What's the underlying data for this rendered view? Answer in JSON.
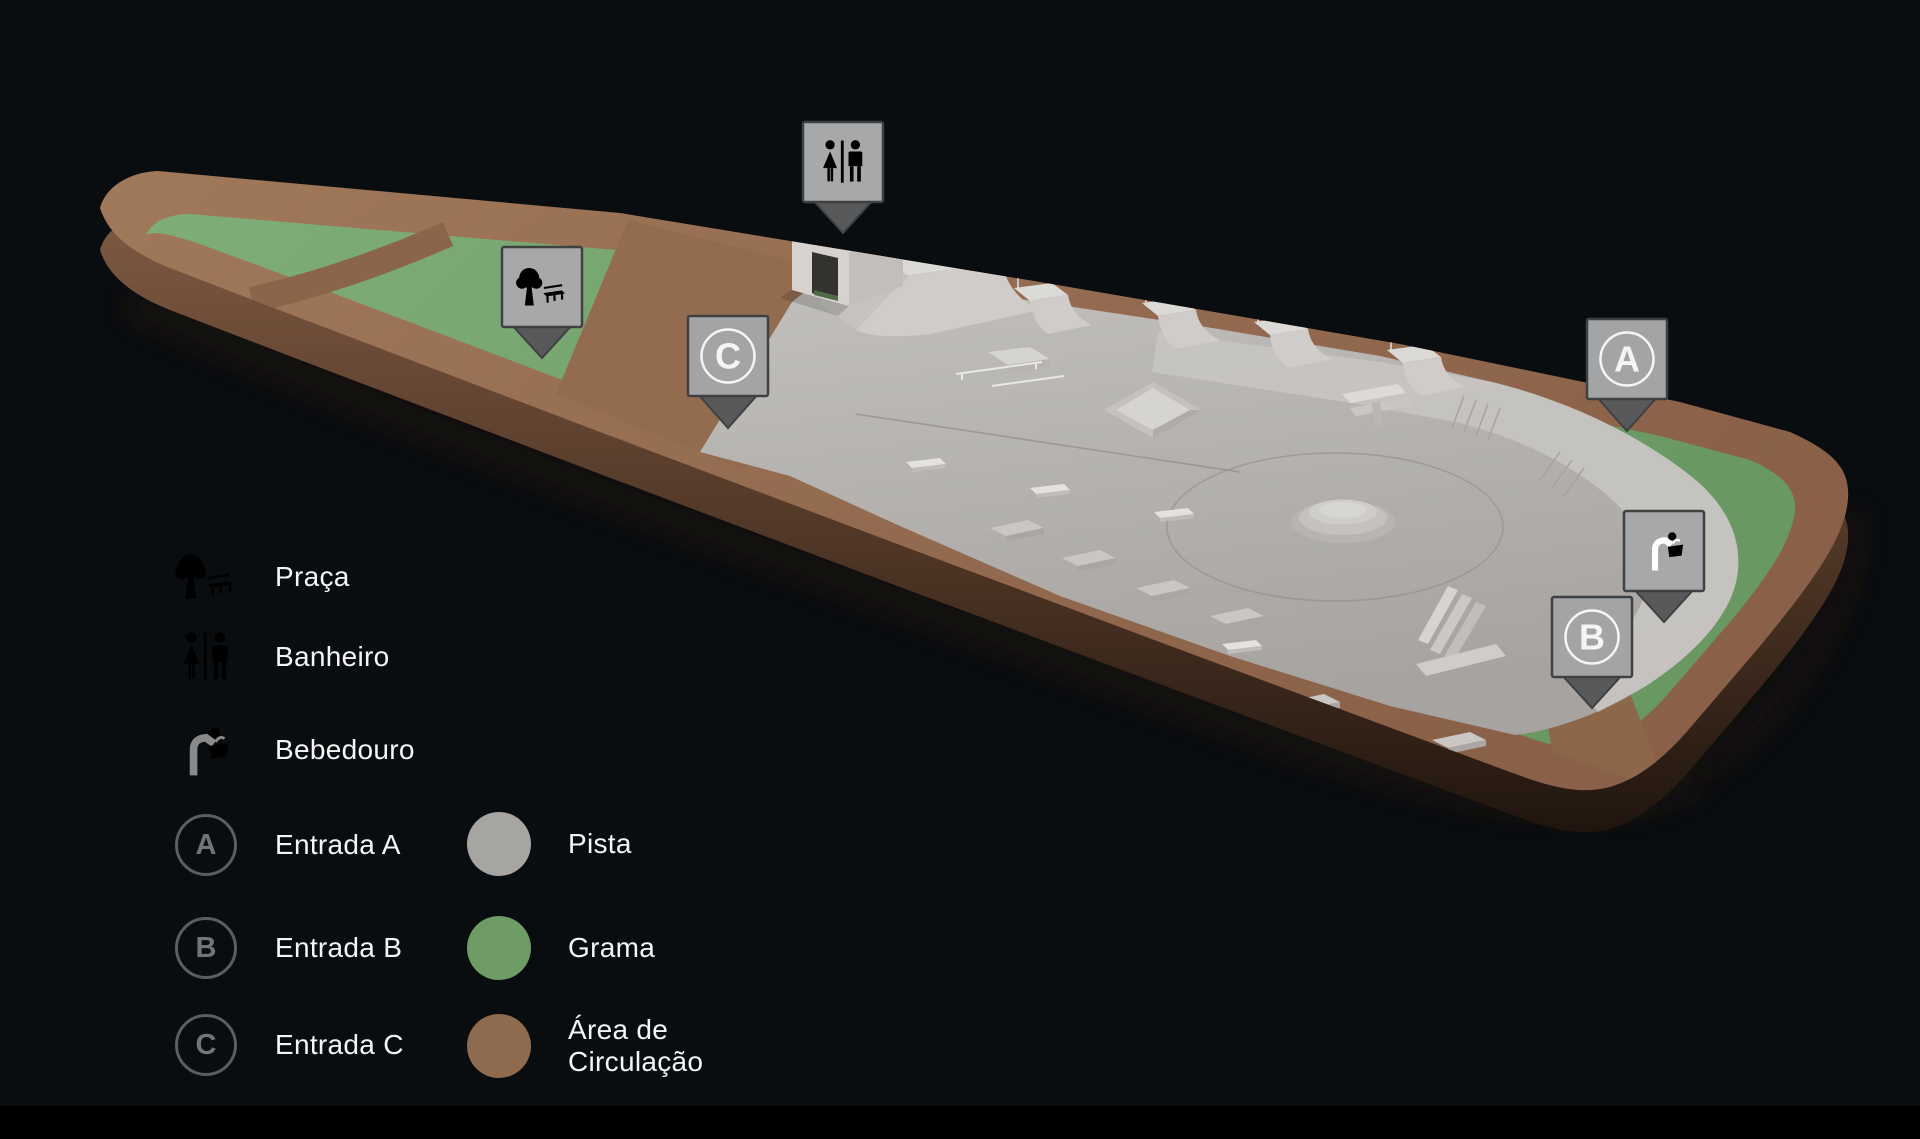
{
  "scene": {
    "background": "#0A0D10",
    "colors": {
      "grass": "#79A571",
      "circulation": "#936C50",
      "pista": "#B3B0AD",
      "park_side": "#6E4C38",
      "marker_fill": "#A2A4A6",
      "marker_tail": "#58595B",
      "marker_icon": "#FFFFFF"
    }
  },
  "map": {
    "markers": {
      "banheiro": {
        "icon": "restroom-icon"
      },
      "praca": {
        "icon": "tree-bench-icon"
      },
      "bebedouro": {
        "icon": "drinking-fountain-icon"
      },
      "entrada_a": {
        "letter": "A"
      },
      "entrada_b": {
        "letter": "B"
      },
      "entrada_c": {
        "letter": "C"
      }
    }
  },
  "legend": {
    "column1": [
      {
        "id": "praca",
        "label": "Praça"
      },
      {
        "id": "banheiro",
        "label": "Banheiro"
      },
      {
        "id": "bebedouro",
        "label": "Bebedouro"
      },
      {
        "id": "entrada-a",
        "badge": "A",
        "label": "Entrada A"
      },
      {
        "id": "entrada-b",
        "badge": "B",
        "label": "Entrada B"
      },
      {
        "id": "entrada-c",
        "badge": "C",
        "label": "Entrada C"
      }
    ],
    "column2": [
      {
        "id": "pista",
        "swatch": "#A7A5A2",
        "label": "Pista"
      },
      {
        "id": "grama",
        "swatch": "#6F9B64",
        "label": "Grama"
      },
      {
        "id": "area-circulacao",
        "swatch": "#8E6B4E",
        "label": "Área de Circulação"
      }
    ]
  }
}
